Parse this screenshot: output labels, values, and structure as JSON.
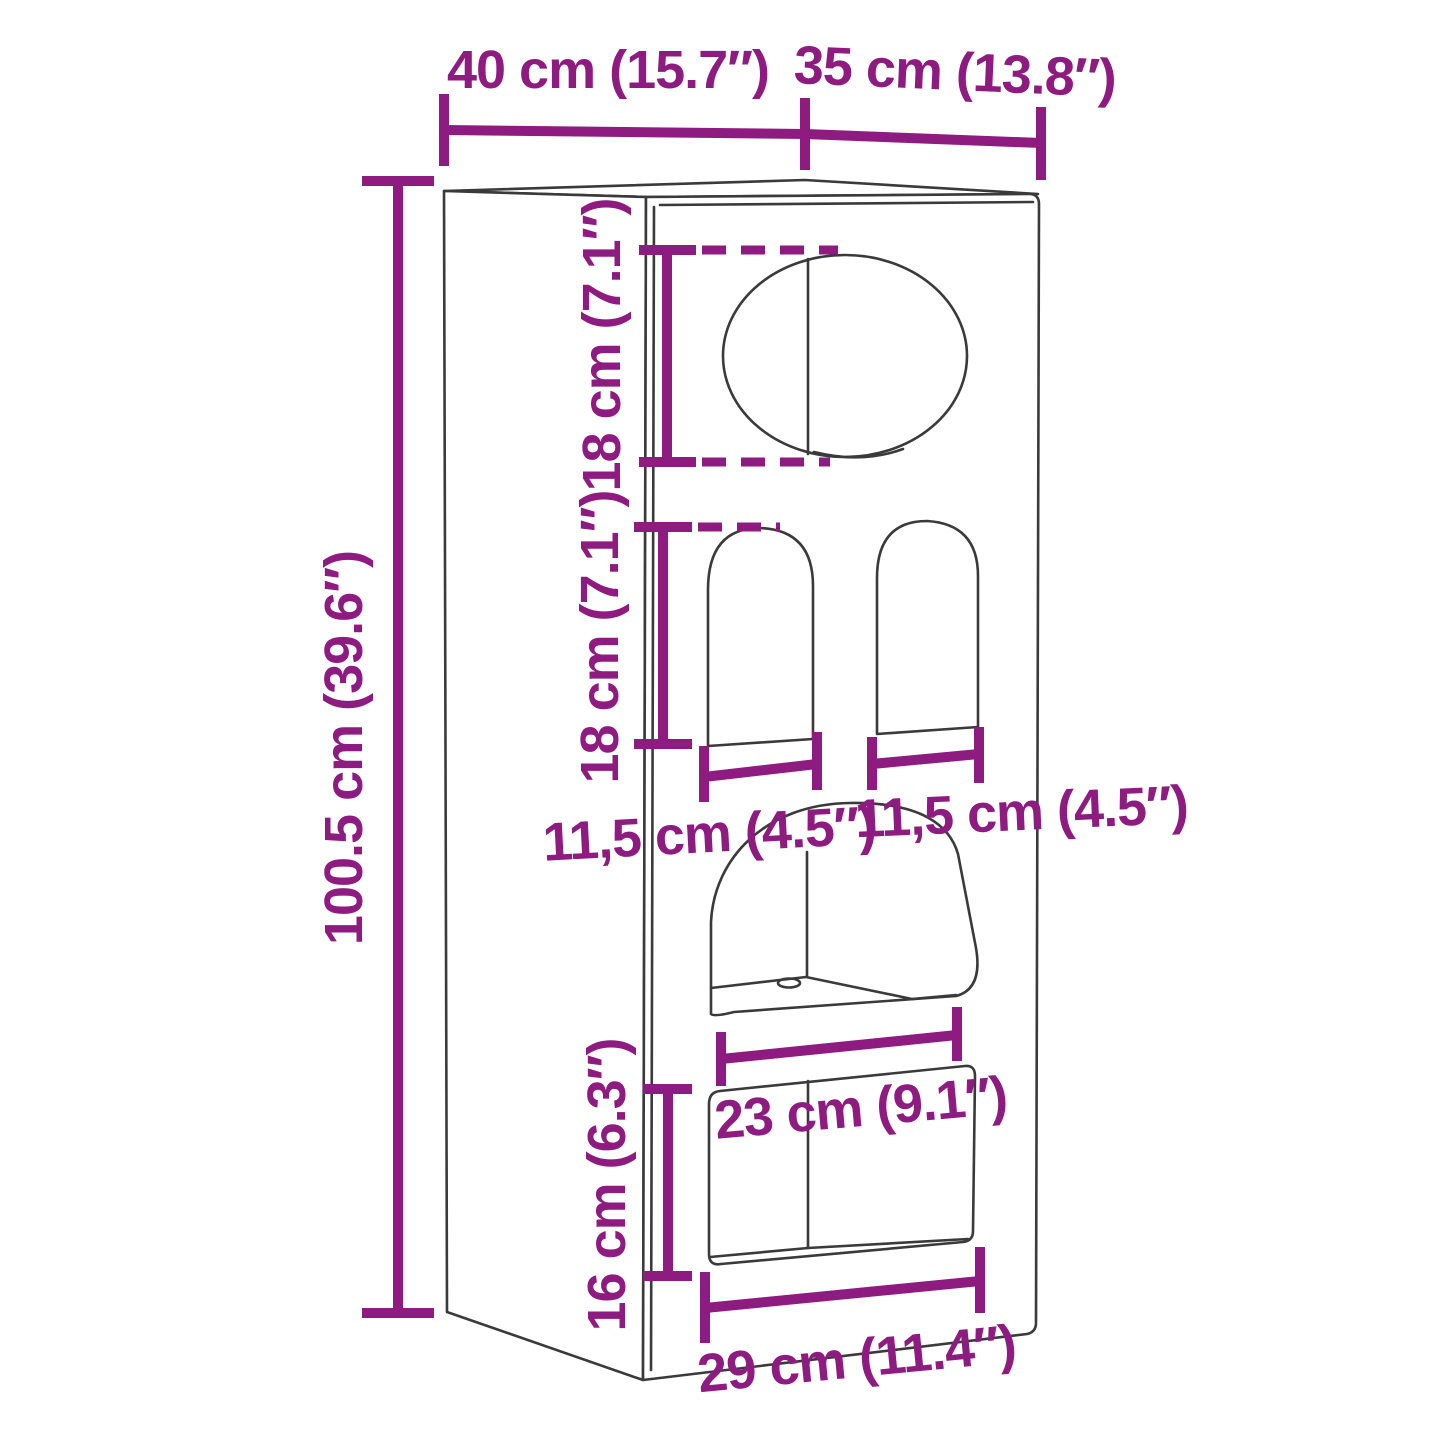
{
  "figure": {
    "kind": "product dimension diagram",
    "subject": "tall wall cabinet / cat house with elliptical opening, two arched openings, curved cubby shelf and rectangular bottom opening",
    "background": "#ffffff"
  },
  "colors": {
    "dimension_accent": "#8e1b80",
    "drawing_line": "#3a3a3a"
  },
  "dimensions": {
    "top_width": "40 cm (15.7″)",
    "top_depth": "35 cm (13.8″)",
    "overall_height": "100.5 cm (39.6″)",
    "ellipse_opening_height": "18 cm (7.1″)",
    "arch_opening_height": "18 cm (7.1″)",
    "arch_left_width": "11,5 cm (4.5″)",
    "arch_right_width": "11,5 cm (4.5″)",
    "cubby_width": "23 cm (9.1″)",
    "bottom_opening_height": "16 cm (6.3″)",
    "bottom_opening_width": "29 cm (11.4″)"
  }
}
